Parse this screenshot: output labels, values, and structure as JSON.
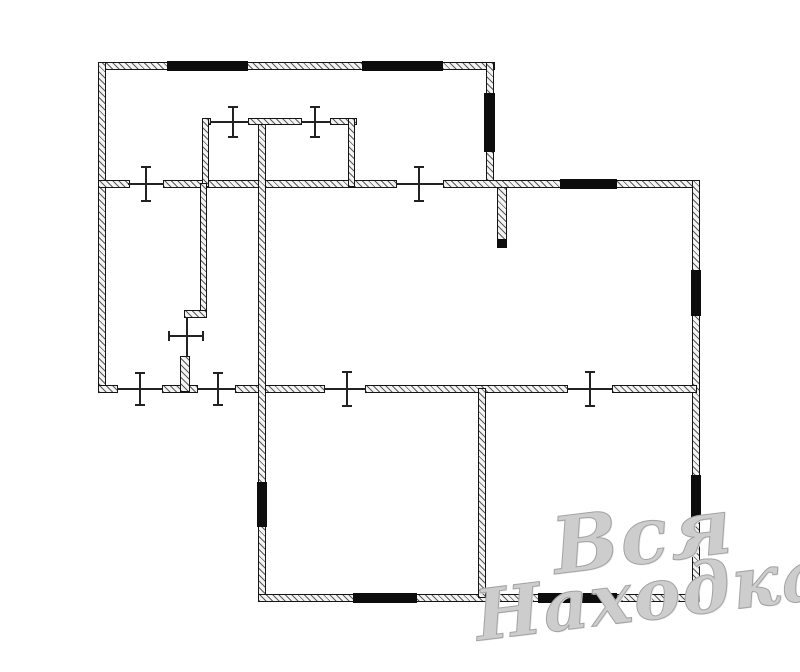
{
  "watermark": {
    "line1": "Вся",
    "line2": "Находка",
    "color": "#cdcdcd"
  },
  "floorplan": {
    "canvas_width": 800,
    "canvas_height": 672,
    "colors": {
      "background": "#ffffff",
      "wall_border": "#141414",
      "wall_fill": "#f3f3f3",
      "hatch": "#5a5a5a",
      "window": "#0d0d0d",
      "line": "#222222"
    },
    "walls": [
      {
        "name": "wall-top-exterior",
        "x": 98,
        "y": 62,
        "w": 397,
        "h": 8
      },
      {
        "name": "wall-left-exterior",
        "x": 98,
        "y": 62,
        "w": 8,
        "h": 330
      },
      {
        "name": "wall-upper-right-exterior",
        "x": 486,
        "y": 62,
        "w": 8,
        "h": 125
      },
      {
        "name": "wall-mid-horizontal-a",
        "x": 98,
        "y": 180,
        "w": 32,
        "h": 8
      },
      {
        "name": "wall-mid-horizontal-b",
        "x": 163,
        "y": 180,
        "w": 234,
        "h": 8
      },
      {
        "name": "wall-mid-horizontal-c",
        "x": 443,
        "y": 180,
        "w": 257,
        "h": 8
      },
      {
        "name": "wall-right-exterior",
        "x": 692,
        "y": 180,
        "w": 8,
        "h": 422
      },
      {
        "name": "wall-lowermid-horizontal-a",
        "x": 98,
        "y": 385,
        "w": 20,
        "h": 8
      },
      {
        "name": "wall-lowermid-horizontal-b",
        "x": 162,
        "y": 385,
        "w": 36,
        "h": 8
      },
      {
        "name": "wall-lowermid-horizontal-c",
        "x": 235,
        "y": 385,
        "w": 90,
        "h": 8
      },
      {
        "name": "wall-lowermid-horizontal-d",
        "x": 365,
        "y": 385,
        "w": 203,
        "h": 8
      },
      {
        "name": "wall-lowermid-horizontal-e",
        "x": 612,
        "y": 385,
        "w": 85,
        "h": 8
      },
      {
        "name": "wall-left-lower-exterior",
        "x": 258,
        "y": 118,
        "w": 8,
        "h": 484
      },
      {
        "name": "wall-bottom-exterior",
        "x": 258,
        "y": 594,
        "w": 442,
        "h": 8
      },
      {
        "name": "wall-bottom-rooms-divider",
        "x": 478,
        "y": 388,
        "w": 8,
        "h": 210
      },
      {
        "name": "wall-closet-top-a",
        "x": 202,
        "y": 118,
        "w": 9,
        "h": 7
      },
      {
        "name": "wall-closet-top-b",
        "x": 248,
        "y": 118,
        "w": 54,
        "h": 7
      },
      {
        "name": "wall-closet-top-c",
        "x": 330,
        "y": 118,
        "w": 27,
        "h": 7
      },
      {
        "name": "wall-closet-left",
        "x": 202,
        "y": 118,
        "w": 7,
        "h": 69
      },
      {
        "name": "wall-closet-right",
        "x": 348,
        "y": 118,
        "w": 7,
        "h": 69
      },
      {
        "name": "wall-bathroom-vertical",
        "x": 200,
        "y": 183,
        "w": 7,
        "h": 130
      },
      {
        "name": "wall-bathroom-jog",
        "x": 184,
        "y": 310,
        "w": 23,
        "h": 8
      },
      {
        "name": "wall-bathroom-stub",
        "x": 180,
        "y": 356,
        "w": 10,
        "h": 36
      },
      {
        "name": "wall-hall-stub",
        "x": 497,
        "y": 187,
        "w": 10,
        "h": 60
      }
    ],
    "windows": [
      {
        "name": "window-top-left",
        "x": 167,
        "y": 61,
        "w": 81,
        "h": 10
      },
      {
        "name": "window-top-right",
        "x": 362,
        "y": 61,
        "w": 81,
        "h": 10
      },
      {
        "name": "window-upper-right-wall",
        "x": 484,
        "y": 93,
        "w": 11,
        "h": 59
      },
      {
        "name": "window-mid-wall-right",
        "x": 560,
        "y": 179,
        "w": 57,
        "h": 10
      },
      {
        "name": "window-right-wall-upper",
        "x": 691,
        "y": 270,
        "w": 10,
        "h": 46
      },
      {
        "name": "window-right-wall-lower",
        "x": 691,
        "y": 475,
        "w": 10,
        "h": 43
      },
      {
        "name": "window-left-lower-wall",
        "x": 257,
        "y": 482,
        "w": 10,
        "h": 45
      },
      {
        "name": "window-bottom-left",
        "x": 353,
        "y": 593,
        "w": 64,
        "h": 10
      },
      {
        "name": "window-bottom-right",
        "x": 538,
        "y": 593,
        "w": 79,
        "h": 10
      },
      {
        "name": "wall-hall-stub-cap",
        "x": 497,
        "y": 239,
        "w": 10,
        "h": 9
      }
    ],
    "door_lines": [
      {
        "name": "door-opening-mid-left",
        "x": 128,
        "y": 183,
        "w": 36,
        "h": 2
      },
      {
        "name": "door-opening-mid-right",
        "x": 396,
        "y": 183,
        "w": 48,
        "h": 2
      },
      {
        "name": "door-opening-lowermid-1",
        "x": 117,
        "y": 388,
        "w": 46,
        "h": 2
      },
      {
        "name": "door-opening-lowermid-2",
        "x": 197,
        "y": 388,
        "w": 39,
        "h": 2
      },
      {
        "name": "door-opening-lowermid-3",
        "x": 324,
        "y": 388,
        "w": 42,
        "h": 2
      },
      {
        "name": "door-opening-lowermid-4",
        "x": 567,
        "y": 388,
        "w": 46,
        "h": 2
      },
      {
        "name": "door-opening-closet-1",
        "x": 210,
        "y": 121,
        "w": 39,
        "h": 2
      },
      {
        "name": "door-opening-closet-2",
        "x": 301,
        "y": 121,
        "w": 30,
        "h": 2
      },
      {
        "name": "door-opening-bathroom",
        "x": 186,
        "y": 317,
        "w": 2,
        "h": 40
      }
    ],
    "door_ticks": [
      {
        "name": "door-tick-mid-left",
        "cx": 146,
        "cy": 184,
        "dir": "v",
        "len": 34
      },
      {
        "name": "door-tick-mid-right",
        "cx": 419,
        "cy": 184,
        "dir": "v",
        "len": 34
      },
      {
        "name": "door-tick-closet-1",
        "cx": 233,
        "cy": 122,
        "dir": "v",
        "len": 30
      },
      {
        "name": "door-tick-closet-2",
        "cx": 315,
        "cy": 122,
        "dir": "v",
        "len": 30
      },
      {
        "name": "door-tick-lowermid-1",
        "cx": 140,
        "cy": 389,
        "dir": "v",
        "len": 32
      },
      {
        "name": "door-tick-lowermid-2",
        "cx": 218,
        "cy": 389,
        "dir": "v",
        "len": 32
      },
      {
        "name": "door-tick-lowermid-3",
        "cx": 347,
        "cy": 389,
        "dir": "v",
        "len": 34
      },
      {
        "name": "door-tick-lowermid-4",
        "cx": 590,
        "cy": 389,
        "dir": "v",
        "len": 34
      },
      {
        "name": "door-tick-bathroom",
        "cx": 186,
        "cy": 336,
        "dir": "h",
        "len": 34
      }
    ]
  }
}
